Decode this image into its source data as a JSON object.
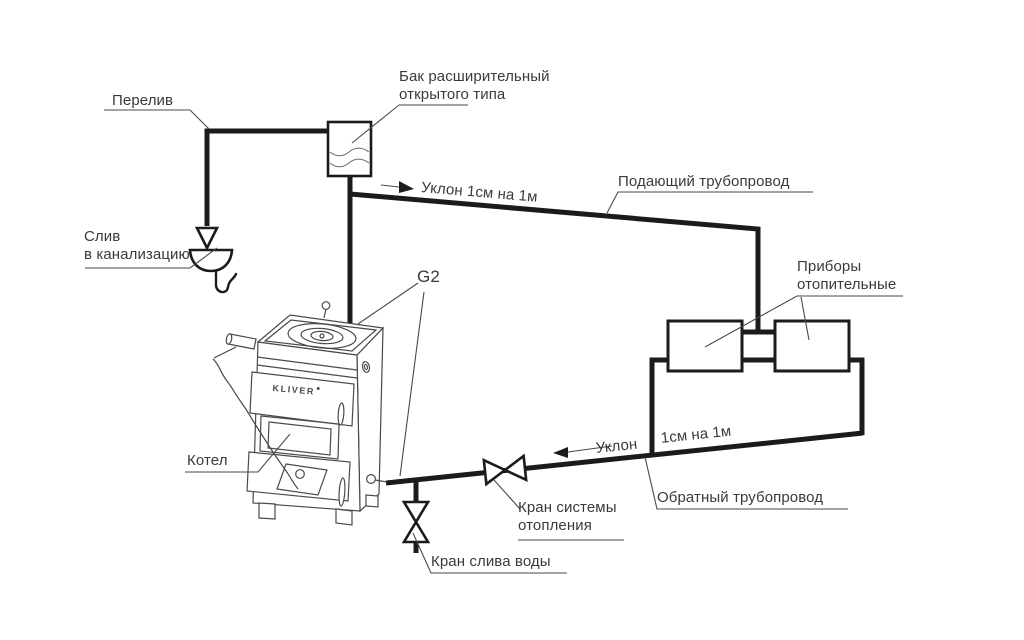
{
  "diagram": {
    "kind": "open-type-gravity-heating-system-schematic",
    "colors": {
      "background": "#ffffff",
      "pipes": "#1b1b1b",
      "text": "#3a3a3a"
    },
    "labels": {
      "overflow": "Перелив",
      "expansion_tank_1": "Бак расширительный",
      "expansion_tank_2": "открытого типа",
      "supply_slope": "Уклон 1см на 1м",
      "supply_pipe": "Подающий трубопровод",
      "boiler_connection": "G2",
      "radiators_1": "Приборы",
      "radiators_2": "отопительные",
      "return_slope_1": "Уклон",
      "return_slope_2": "1см на 1м",
      "return_pipe": "Обратный трубопровод",
      "system_valve_1": "Кран системы",
      "system_valve_2": "отопления",
      "drain_valve": "Кран слива воды",
      "boiler": "Котел",
      "boiler_brand": "KLIVER",
      "sewer_1": "Слив",
      "sewer_2": "в канализацию"
    }
  }
}
